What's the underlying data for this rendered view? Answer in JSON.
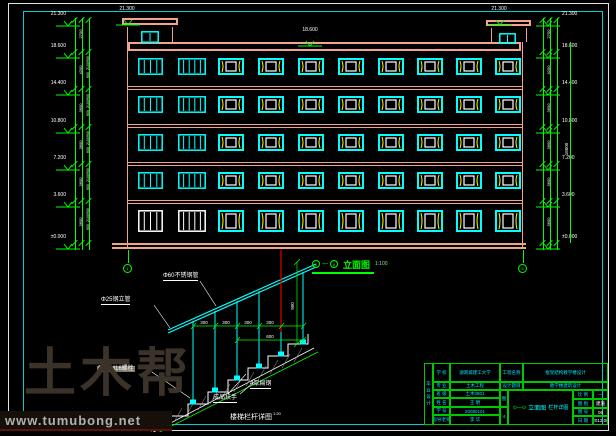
{
  "watermark": {
    "brand": "土木帮",
    "url": "www.tumubong.net"
  },
  "elevation": {
    "axis_start": "1",
    "axis_end": "8",
    "title": "立面图",
    "scale": "1:100",
    "bulkhead_level": "21.300",
    "roof_level": "18.600",
    "levels": [
      "21.300",
      "18.600",
      "14.400",
      "10.800",
      "7.200",
      "3.600",
      "±0.000"
    ],
    "segment_dims": [
      "2700",
      "4200",
      "3600",
      "3600",
      "3600",
      "3600"
    ],
    "window_dims": [
      "900",
      "2100",
      "600"
    ],
    "overall_height": "18600",
    "floors": 5,
    "strip_windows_per_floor": 2,
    "casement_windows_per_floor": 8
  },
  "detail": {
    "title": "楼梯栏杆详图",
    "scale": "1:20",
    "handrail_label": "Φ60不锈钢管",
    "post_label": "Φ25钢立管",
    "embed_label": "预埋M16螺栓",
    "handrail_product_label": "成品扶手",
    "flat_steel_label": "4厚扁钢",
    "dim_spacing": "300",
    "dim_width": "600",
    "dim_height": "900"
  },
  "title_block": {
    "side_vertical": "毕业设计",
    "rows": [
      {
        "label": "学 校",
        "value": "湖南城建工大学"
      },
      {
        "label": "专 业",
        "value": "土木工程"
      },
      {
        "label": "班 级",
        "value": "土木0801"
      },
      {
        "label": "姓 名",
        "value": "王 明"
      },
      {
        "label": "学 号",
        "value": "20080101"
      },
      {
        "label": "指导老师",
        "value": "李 华"
      }
    ],
    "project_label": "工程名称",
    "project_value": "框架结构教学楼设计",
    "subject_label": "设计题目",
    "subject_value": "教学楼建筑设计",
    "sheet_char": "图",
    "sheet_num": "4",
    "drawing_axis": "⊙—⊙",
    "drawing_title": "立面图",
    "drawing_title2": "栏杆详图",
    "meta": [
      {
        "label": "比 例",
        "value": "—"
      },
      {
        "label": "图 别",
        "value": "建施"
      },
      {
        "label": "图 号",
        "value": "06"
      },
      {
        "label": "日 期",
        "value": "2012.06"
      }
    ]
  },
  "colors": {
    "band": "#f2a38d",
    "cyan": "#00ffff",
    "green": "#00ff00",
    "yellow": "#ffff00",
    "red": "#e00000",
    "white": "#ffffff",
    "table_border": "#00c800",
    "watermark_text": "#3b322a",
    "watermark_url": "#b0b0b0"
  }
}
